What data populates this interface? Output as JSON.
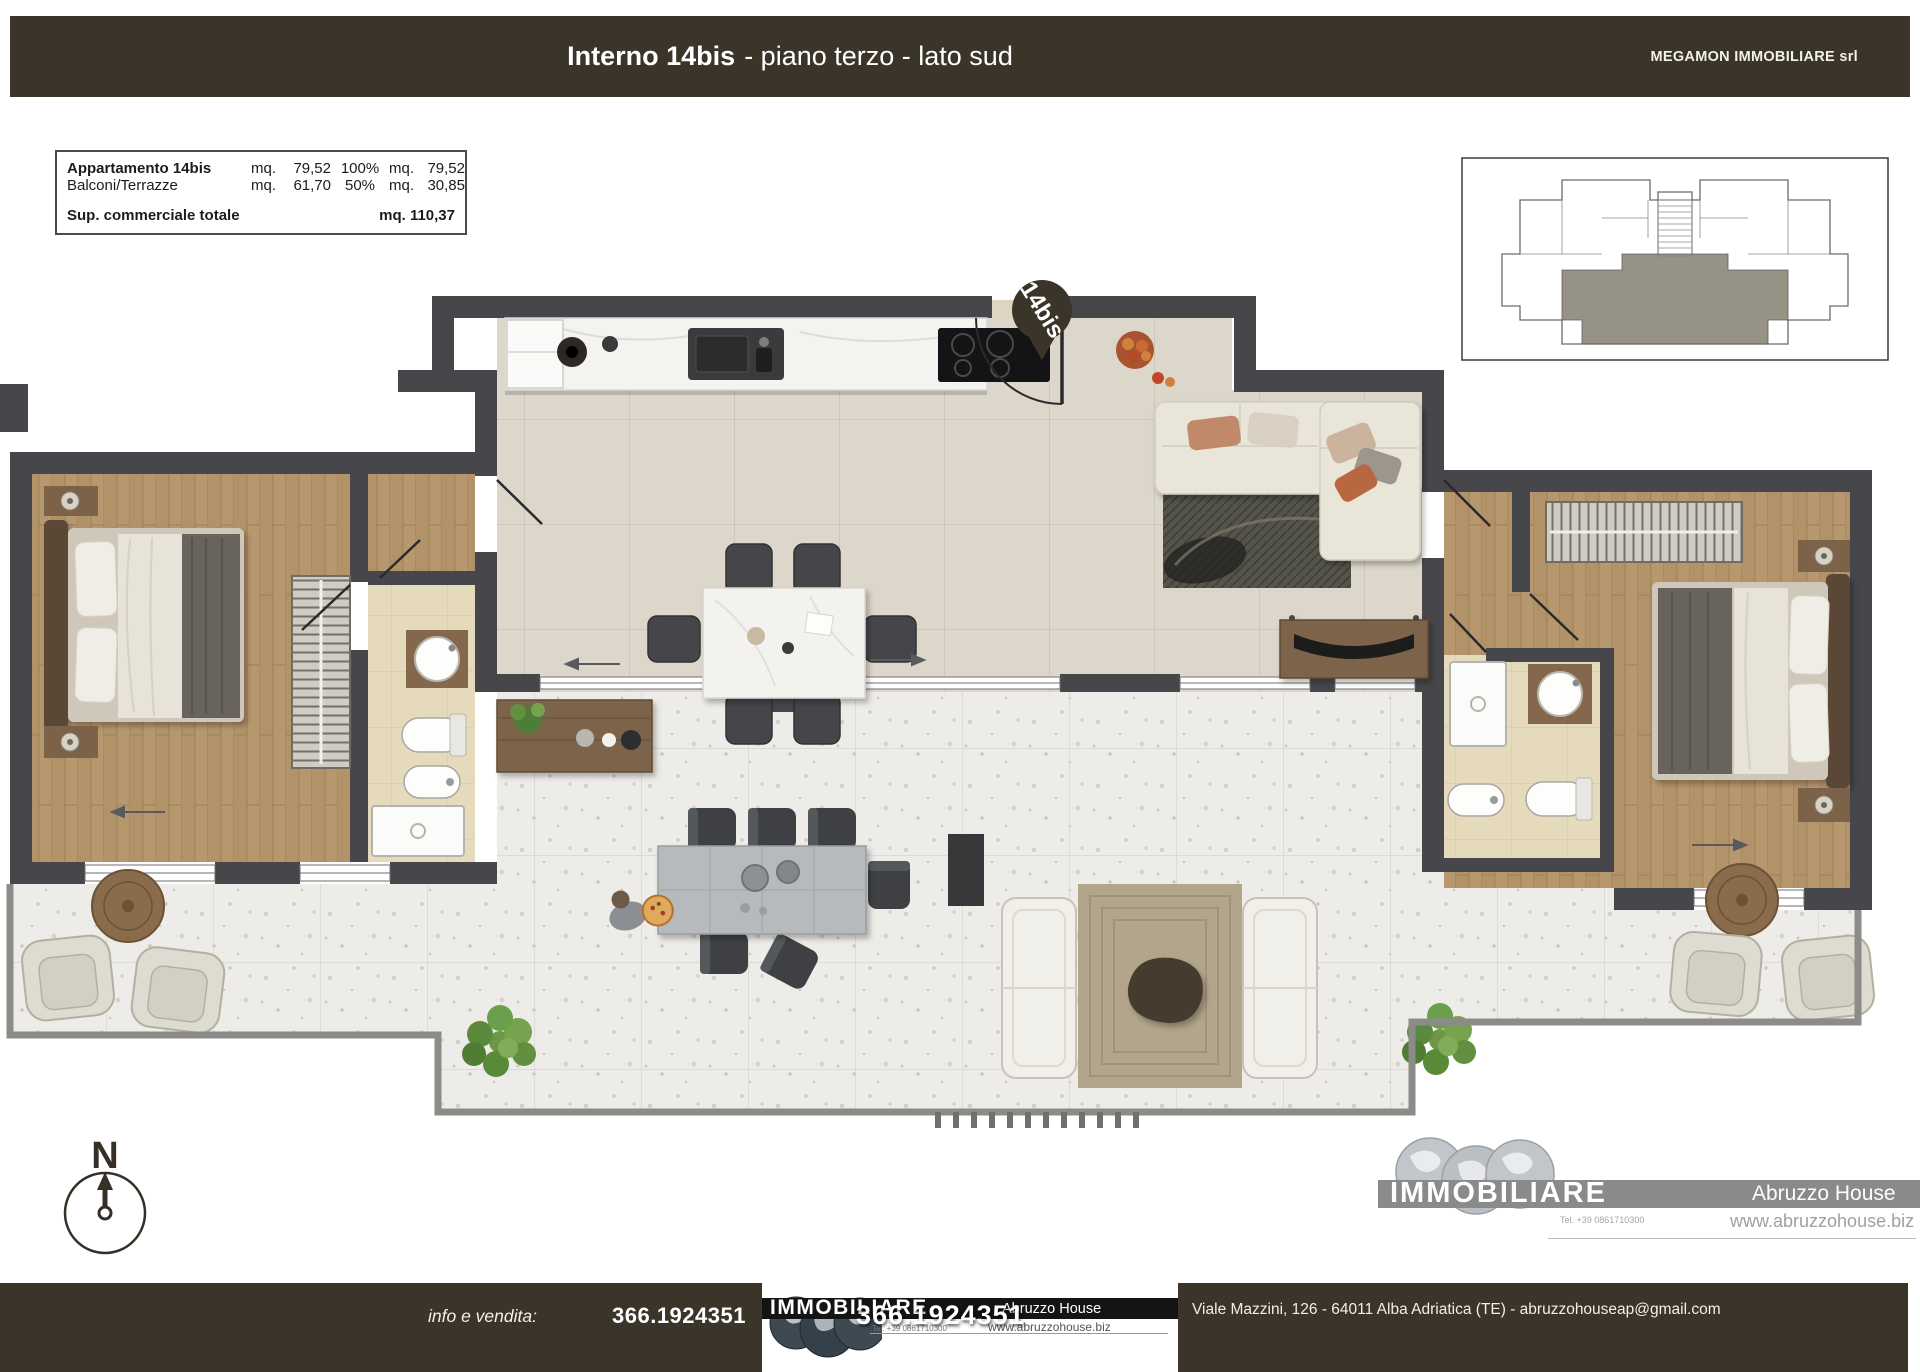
{
  "header": {
    "title_main": "Interno 14bis",
    "title_sub": "- piano terzo - lato sud",
    "company": "MEGAMON IMMOBILIARE srl"
  },
  "area_table": {
    "rows": [
      {
        "label": "Appartamento 14bis",
        "u1": "mq.",
        "v1": "79,52",
        "pct": "100%",
        "u2": "mq.",
        "v2": "79,52"
      },
      {
        "label": "Balconi/Terrazze",
        "u1": "mq.",
        "v1": "61,70",
        "pct": "50%",
        "u2": "mq.",
        "v2": "30,85"
      }
    ],
    "total_label": "Sup. commerciale totale",
    "total_value": "mq. 110,37"
  },
  "plan": {
    "pin_label": "14bis",
    "compass_label": "N"
  },
  "brand": {
    "name": "IMMOBILIARE",
    "agency": "Abruzzo House",
    "tel": "Tel. +39 0861710300",
    "website": "www.abruzzohouse.biz"
  },
  "footer": {
    "info_label": "info e vendita:",
    "phone": "366.1924351",
    "phone_overlay": "366.1924351",
    "address": "Viale Mazzini, 126 - 64011 Alba Adriatica (TE) - abruzzohouseap@gmail.com"
  },
  "icons": {
    "pin": "location-pin",
    "compass": "north-compass",
    "globes": "globe-logo"
  },
  "colors": {
    "header_bg": "#3a3429",
    "wall": "#47474b",
    "wood": "#b7986e",
    "tile": "#dcd7ca",
    "bath": "#e6dabd",
    "terrace": "#edece8",
    "banner_gray": "#8a8a8a",
    "banner_black": "#141414",
    "unit_highlight": "#8e897c"
  }
}
